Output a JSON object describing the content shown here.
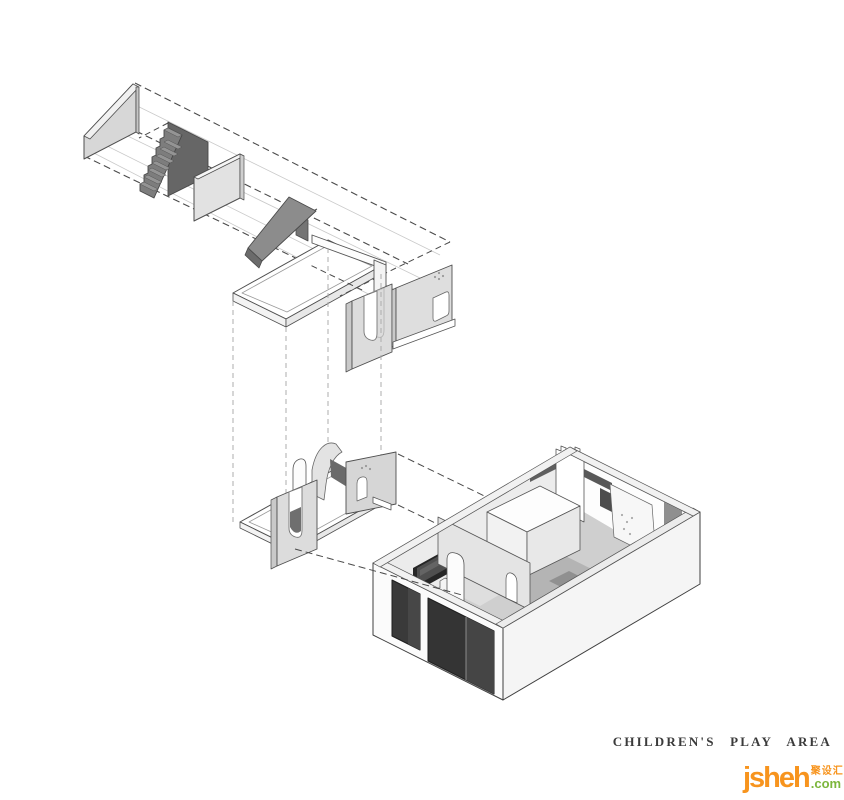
{
  "caption": {
    "text": "CHILDREN'S PLAY AREA"
  },
  "logo": {
    "name": "jsheh",
    "cjk": "聚设汇",
    "tld": ".com"
  },
  "palette": {
    "outline": "#3f3f3f",
    "dash_dark": "#4a4a4a",
    "dash_light": "#a6a6a6",
    "guide_gray": "#c9c9c9",
    "panel_light": "#dcdcdc",
    "panel_mid": "#8c8c8c",
    "piece_dark": "#6b6b6b",
    "wall_white": "#fafafa",
    "floor_gray": "#cfcfcf",
    "carpet_gray": "#b4b4b4",
    "window_dark": "#343434",
    "chalkboard_black": "#262626",
    "caption_color": "#3b3b3b",
    "logo_orange": "#f7941e",
    "logo_green": "#7cb63c"
  },
  "components": [
    "ramp-side-wall",
    "staircase",
    "partition-panel",
    "slide",
    "mezzanine-platform-frame",
    "guard-rail-beam",
    "slotted-panel",
    "window-wall",
    "play-structure-base",
    "curved-slide",
    "arched-panel",
    "play-room",
    "chalkboard",
    "castellated-tower",
    "climbing-panel",
    "play-cube"
  ]
}
